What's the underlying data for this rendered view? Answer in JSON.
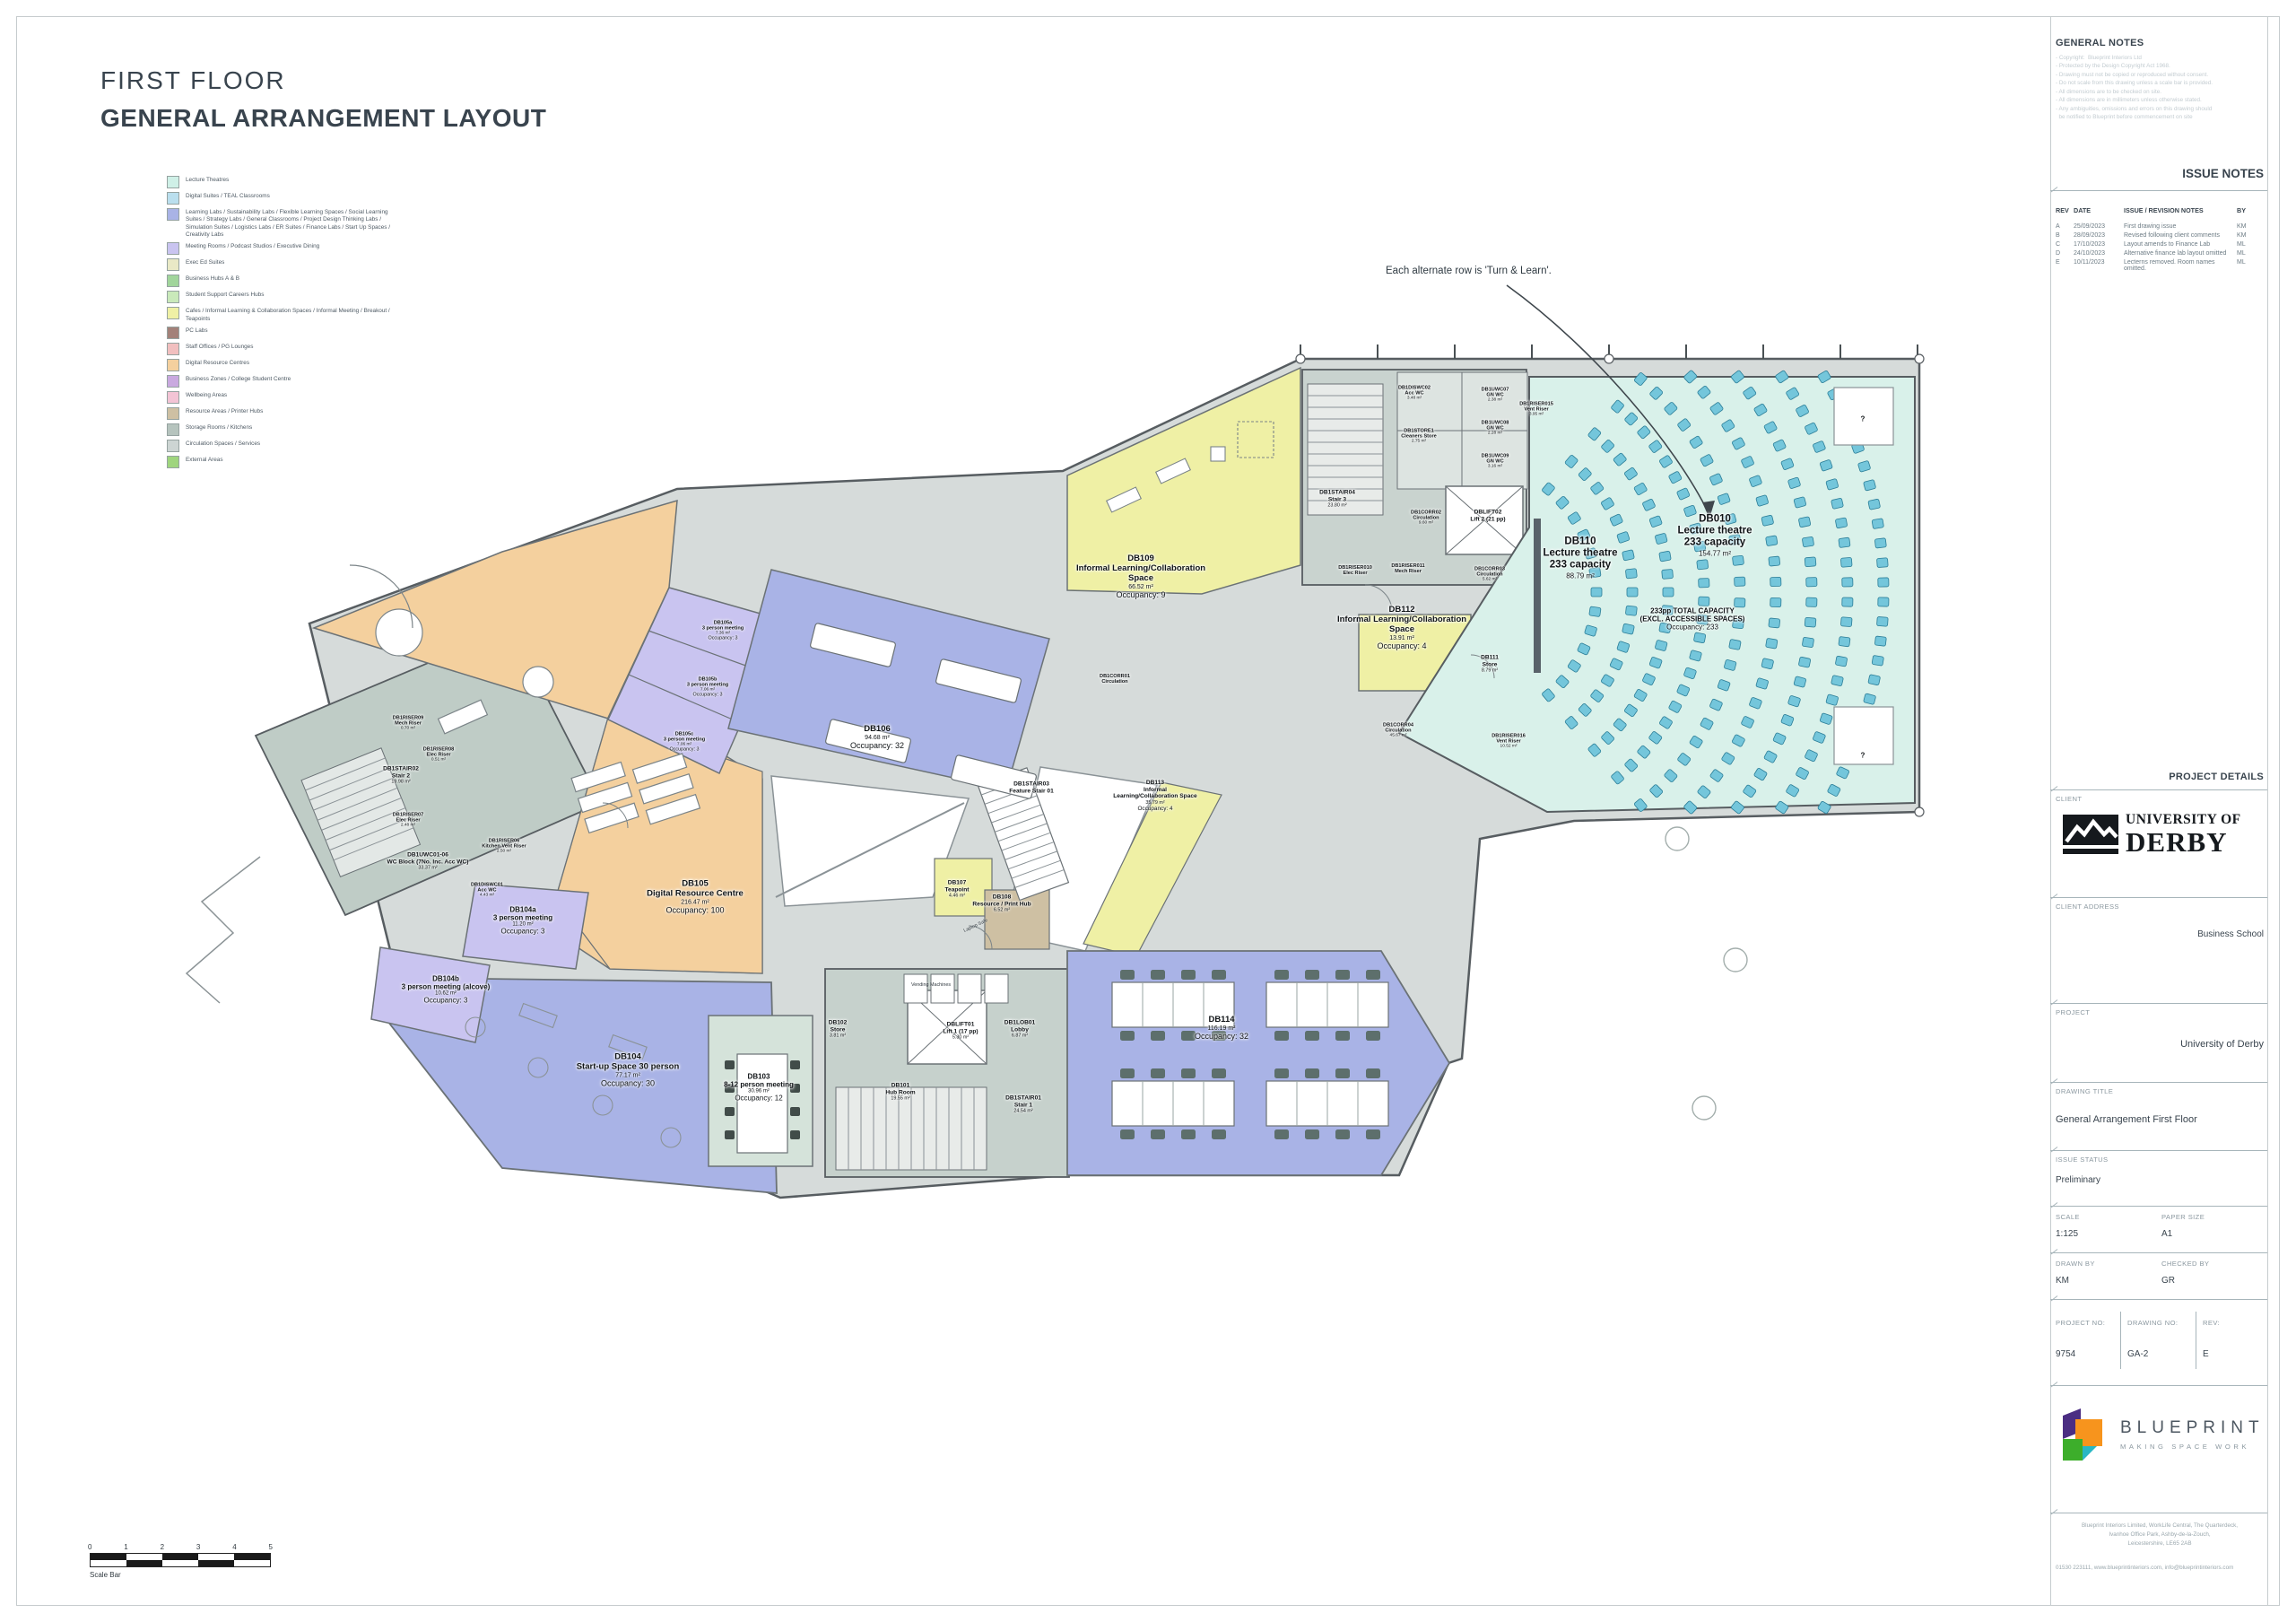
{
  "sheet": {
    "title_line1": "FIRST FLOOR",
    "title_line2": "GENERAL ARRANGEMENT LAYOUT"
  },
  "legend": {
    "items": [
      {
        "label": "Lecture Theatres",
        "color": "#cff0e7"
      },
      {
        "label": "Digital Suites / TEAL Classrooms",
        "color": "#badfee"
      },
      {
        "label": "Learning Labs / Sustainability Labs / Flexible Learning Spaces / Social Learning Suites / Strategy Labs / General Classrooms / Project Design Thinking Labs / Simulation Suites / Logistics Labs / ER Suites / Finance Labs / Start Up Spaces / Creativity Labs",
        "color": "#a9b3e6"
      },
      {
        "label": "Meeting Rooms / Podcast Studios / Executive Dining",
        "color": "#c9c4f0"
      },
      {
        "label": "Exec Ed Suites",
        "color": "#e9e9c6"
      },
      {
        "label": "Business Hubs A & B",
        "color": "#a1d59b"
      },
      {
        "label": "Student Support Careers Hubs",
        "color": "#c9e9ba"
      },
      {
        "label": "Cafes / Informal Learning & Collaboration Spaces / Informal Meeting / Breakout / Teapoints",
        "color": "#eff0a5"
      },
      {
        "label": "PC Labs",
        "color": "#a38179"
      },
      {
        "label": "Staff Offices / PG Lounges",
        "color": "#f1bfbf"
      },
      {
        "label": "Digital Resource Centres",
        "color": "#f4d09e"
      },
      {
        "label": "Business Zones / College Student Centre",
        "color": "#c9a9df"
      },
      {
        "label": "Wellbeing Areas",
        "color": "#f3c4d5"
      },
      {
        "label": "Resource Areas / Printer Hubs",
        "color": "#cec0a3"
      },
      {
        "label": "Storage Rooms / Kitchens",
        "color": "#b6c4be"
      },
      {
        "label": "Circulation Spaces / Services",
        "color": "#cdd5d3"
      },
      {
        "label": "External Areas",
        "color": "#9fd57e"
      }
    ]
  },
  "general_notes": {
    "heading": "GENERAL NOTES",
    "lines": [
      "- Copyright:  Blueprint Interiors Ltd",
      "- Protected by the Design Copyright Act 1968.",
      "- Drawing must not be copied or reproduced without consent.",
      "- Do not scale from this drawing unless a scale bar is provided.",
      "- All dimensions are to be checked on site.",
      "- All dimensions are in millimeters unless otherwise stated.",
      "- Any ambiguities, omissions and errors on this drawing should",
      "  be notified to Blueprint before commencement on site"
    ]
  },
  "issue_notes": {
    "heading": "ISSUE NOTES",
    "columns": [
      "REV",
      "DATE",
      "ISSUE / REVISION NOTES",
      "BY"
    ],
    "rows": [
      {
        "rev": "A",
        "date": "25/09/2023",
        "notes": "First drawing issue",
        "by": "KM"
      },
      {
        "rev": "B",
        "date": "28/09/2023",
        "notes": "Revised following client comments",
        "by": "KM"
      },
      {
        "rev": "C",
        "date": "17/10/2023",
        "notes": "Layout amends to Finance Lab",
        "by": "ML"
      },
      {
        "rev": "D",
        "date": "24/10/2023",
        "notes": "Alternative finance lab layout omitted",
        "by": "ML"
      },
      {
        "rev": "E",
        "date": "10/11/2023",
        "notes": "Lecterns removed. Room names omitted.",
        "by": "ML"
      }
    ]
  },
  "project_details": {
    "heading": "PROJECT DETAILS",
    "client_label": "CLIENT",
    "client_logo_line1": "UNIVERSITY OF",
    "client_logo_line2": "DERBY",
    "client_address_label": "CLIENT ADDRESS",
    "client_address": "Business School",
    "project_label": "PROJECT",
    "project": "University of Derby",
    "drawing_title_label": "DRAWING TITLE",
    "drawing_title": "General Arrangement First Floor",
    "issue_status_label": "ISSUE STATUS",
    "issue_status": "Preliminary",
    "scale_label": "SCALE",
    "scale": "1:125",
    "paper_size_label": "PAPER SIZE",
    "paper_size": "A1",
    "drawn_by_label": "DRAWN BY",
    "drawn_by": "KM",
    "checked_by_label": "CHECKED BY",
    "checked_by": "GR",
    "project_no_label": "PROJECT NO:",
    "project_no": "9754",
    "drawing_no_label": "DRAWING NO:",
    "drawing_no": "GA-2",
    "rev_label": "REV:",
    "rev": "E"
  },
  "branding": {
    "name": "BLUEPRINT",
    "tagline": "MAKING SPACE WORK",
    "address_lines": [
      "Blueprint Interiors Limited, WorkLife Central, The Quarterdeck,",
      "Ivanhoe Office Park, Ashby-de-la-Zouch,",
      "Leicestershire, LE65 2AB"
    ],
    "contact": "01530 223111, www.blueprintinteriors.com, info@blueprintinteriors.com"
  },
  "scale_bar": {
    "numbers": [
      "0",
      "1",
      "2",
      "3",
      "4",
      "5"
    ],
    "label": "Scale Bar"
  },
  "plan": {
    "annotation": "Each alternate row is 'Turn & Learn'.",
    "rooms": [
      {
        "key": "DB105",
        "id": "DB105",
        "name": "Digital Resource Centre",
        "area": "216.47 m²",
        "occ": "Occupancy: 100",
        "cls": "l"
      },
      {
        "key": "DB106",
        "id": "DB106",
        "name": "",
        "area": "94.68 m²",
        "occ": "Occupancy: 32",
        "cls": "l"
      },
      {
        "key": "DB105a",
        "id": "DB105a",
        "name": "3 person meeting",
        "area": "7.36 m²",
        "occ": "Occupancy: 3",
        "cls": "xs"
      },
      {
        "key": "DB105b",
        "id": "DB105b",
        "name": "3 person meeting",
        "area": "7.06 m²",
        "occ": "Occupancy: 3",
        "cls": "xs"
      },
      {
        "key": "DB105c",
        "id": "DB105c",
        "name": "3 person meeting",
        "area": "7.06 m²",
        "occ": "Occupancy: 3",
        "cls": "xs"
      },
      {
        "key": "DB104a",
        "id": "DB104a",
        "name": "3 person meeting",
        "area": "11.20 m²",
        "occ": "Occupancy: 3",
        "cls": "m"
      },
      {
        "key": "DB104b",
        "id": "DB104b",
        "name": "3 person meeting (alcove)",
        "area": "10.62 m²",
        "occ": "Occupancy: 3",
        "cls": "m"
      },
      {
        "key": "DB104",
        "id": "DB104",
        "name": "Start-up Space 30 person",
        "area": "77.17 m²",
        "occ": "Occupancy: 30",
        "cls": "l"
      },
      {
        "key": "DB103",
        "id": "DB103",
        "name": "8-12 person meeting",
        "area": "30.96 m²",
        "occ": "Occupancy: 12",
        "cls": "m"
      },
      {
        "key": "DB114",
        "id": "DB114",
        "name": "",
        "area": "116.19 m²",
        "occ": "Occupancy: 32",
        "cls": "l"
      },
      {
        "key": "DB109",
        "id": "DB109",
        "name": "Informal Learning/Collaboration Space",
        "area": "66.52 m²",
        "occ": "Occupancy: 9",
        "cls": "l"
      },
      {
        "key": "DB112",
        "id": "DB112",
        "name": "Informal Learning/Collaboration Space",
        "area": "13.91 m²",
        "occ": "Occupancy: 4",
        "cls": "l"
      },
      {
        "key": "DB113",
        "id": "DB113",
        "name": "Informal Learning/Collaboration Space",
        "area": "35.79 m²",
        "occ": "Occupancy: 4",
        "cls": "s"
      },
      {
        "key": "DB110",
        "id": "DB110",
        "name": "Lecture theatre",
        "cap": "233 capacity",
        "area": "88.79 m²",
        "cls": "xl"
      },
      {
        "key": "DB010",
        "id": "DB010",
        "name": "Lecture theatre",
        "cap": "233 capacity",
        "area": "154.77 m²",
        "cls": "xl"
      },
      {
        "key": "TNOTE",
        "id": "",
        "name": "233pp TOTAL CAPACITY\n(EXCL. ACCESSIBLE SPACES)",
        "occ": "Occupancy: 233",
        "cls": "m"
      },
      {
        "key": "DB107",
        "id": "DB107",
        "name": "Teapoint",
        "area": "4.46 m²",
        "cls": "s"
      },
      {
        "key": "DB108",
        "id": "DB108",
        "name": "Resource / Print Hub",
        "area": "6.52 m²",
        "cls": "s"
      },
      {
        "key": "DB101",
        "id": "DB101",
        "name": "Hub Room",
        "area": "19.55 m²",
        "cls": "s"
      },
      {
        "key": "DB102",
        "id": "DB102",
        "name": "Store",
        "area": "3.81 m²",
        "cls": "s"
      },
      {
        "key": "LIFT1",
        "id": "DBLIFT01",
        "name": "Lift 1 (17 pp)",
        "area": "5.30 m²",
        "cls": "s"
      },
      {
        "key": "LOB01",
        "id": "DB1LOB01",
        "name": "Lobby",
        "area": "6.87 m²",
        "cls": "s"
      },
      {
        "key": "STAIR1",
        "id": "DB1STAIR01",
        "name": "Stair 1",
        "area": "24.54 m²",
        "cls": "s"
      },
      {
        "key": "STAIR2",
        "id": "DB1STAIR02",
        "name": "Stair 2",
        "area": "19.98 m²",
        "cls": "s"
      },
      {
        "key": "WCBLOCK",
        "id": "DB1UWC01-06",
        "name": "WC Block (7No. Inc. Acc WC)",
        "area": "33.37 m²",
        "cls": "s"
      },
      {
        "key": "DISWC01",
        "id": "DB1DISWC01",
        "name": "Acc WC",
        "area": "4.43 m²",
        "cls": "xs"
      },
      {
        "key": "RISER06",
        "id": "DB1RISER06",
        "name": "Kitchen Vent Riser",
        "area": "2.50 m²",
        "cls": "xs"
      },
      {
        "key": "STAIR4",
        "id": "DB1STAIR04",
        "name": "Stair 3",
        "area": "23.80 m²",
        "cls": "s"
      },
      {
        "key": "LIFT2",
        "id": "DBLIFT02",
        "name": "Lift 2 (21 pp)",
        "cls": "s"
      },
      {
        "key": "DISWC02",
        "id": "DB1DISWC02",
        "name": "Acc WC",
        "area": "3.48 m²",
        "cls": "xs"
      },
      {
        "key": "CLEAN",
        "id": "DB1STORE1",
        "name": "Cleaners Store",
        "area": "2.75 m²",
        "cls": "xs"
      },
      {
        "key": "UWC07",
        "id": "DB1UWC07",
        "name": "GN WC",
        "area": "2.38 m²",
        "cls": "xs"
      },
      {
        "key": "UWC08",
        "id": "DB1UWC08",
        "name": "GN WC",
        "area": "2.28 m²",
        "cls": "xs"
      },
      {
        "key": "UWC09",
        "id": "DB1UWC09",
        "name": "GN WC",
        "area": "3.16 m²",
        "cls": "xs"
      },
      {
        "key": "RISER015",
        "id": "DB1RISER015",
        "name": "Vent Riser",
        "area": "3.95 m²",
        "cls": "xs"
      },
      {
        "key": "DB111",
        "id": "DB111",
        "name": "Store",
        "area": "8.79 m²",
        "cls": "s"
      },
      {
        "key": "CORR03",
        "id": "DB1CORR03",
        "name": "Circulation",
        "area": "5.62 m²",
        "cls": "xs"
      },
      {
        "key": "CORR04",
        "id": "DB1CORR04",
        "name": "Circulation",
        "area": "45.67 m²",
        "cls": "xs"
      },
      {
        "key": "RISER016",
        "id": "DB1RISER016",
        "name": "Vent Riser",
        "area": "10.52 m²",
        "cls": "xs"
      },
      {
        "key": "CORR01",
        "id": "DB1CORR01",
        "name": "Circulation",
        "cls": "xs"
      },
      {
        "key": "CORR02",
        "id": "DB1CORR02",
        "name": "Circulation",
        "area": "9.60 m²",
        "cls": "xs"
      },
      {
        "key": "FSTAIR",
        "id": "DB1STAIR03",
        "name": "Feature Stair 01",
        "cls": "s"
      },
      {
        "key": "RISER010",
        "id": "DB1RISER010",
        "name": "Elec Riser",
        "cls": "xs"
      },
      {
        "key": "RISER011",
        "id": "DB1RISER011",
        "name": "Mech Riser",
        "cls": "xs"
      },
      {
        "key": "RISER09",
        "id": "DB1RISER09",
        "name": "Mech Riser",
        "area": "0.70 m²",
        "cls": "xs"
      },
      {
        "key": "RISER08",
        "id": "DB1RISER08",
        "name": "Elec Riser",
        "area": "0.51 m²",
        "cls": "xs"
      },
      {
        "key": "RISER07",
        "id": "DB1RISER07",
        "name": "Elec Riser",
        "area": "2.48 m²",
        "cls": "xs"
      },
      {
        "key": "QM1",
        "id": "?",
        "cls": "m"
      },
      {
        "key": "QM2",
        "id": "?",
        "cls": "m"
      }
    ],
    "misc_labels": [
      {
        "key": "laptop",
        "text": "Laptop Safe"
      },
      {
        "key": "vending",
        "text": "Vending Machines"
      }
    ]
  }
}
